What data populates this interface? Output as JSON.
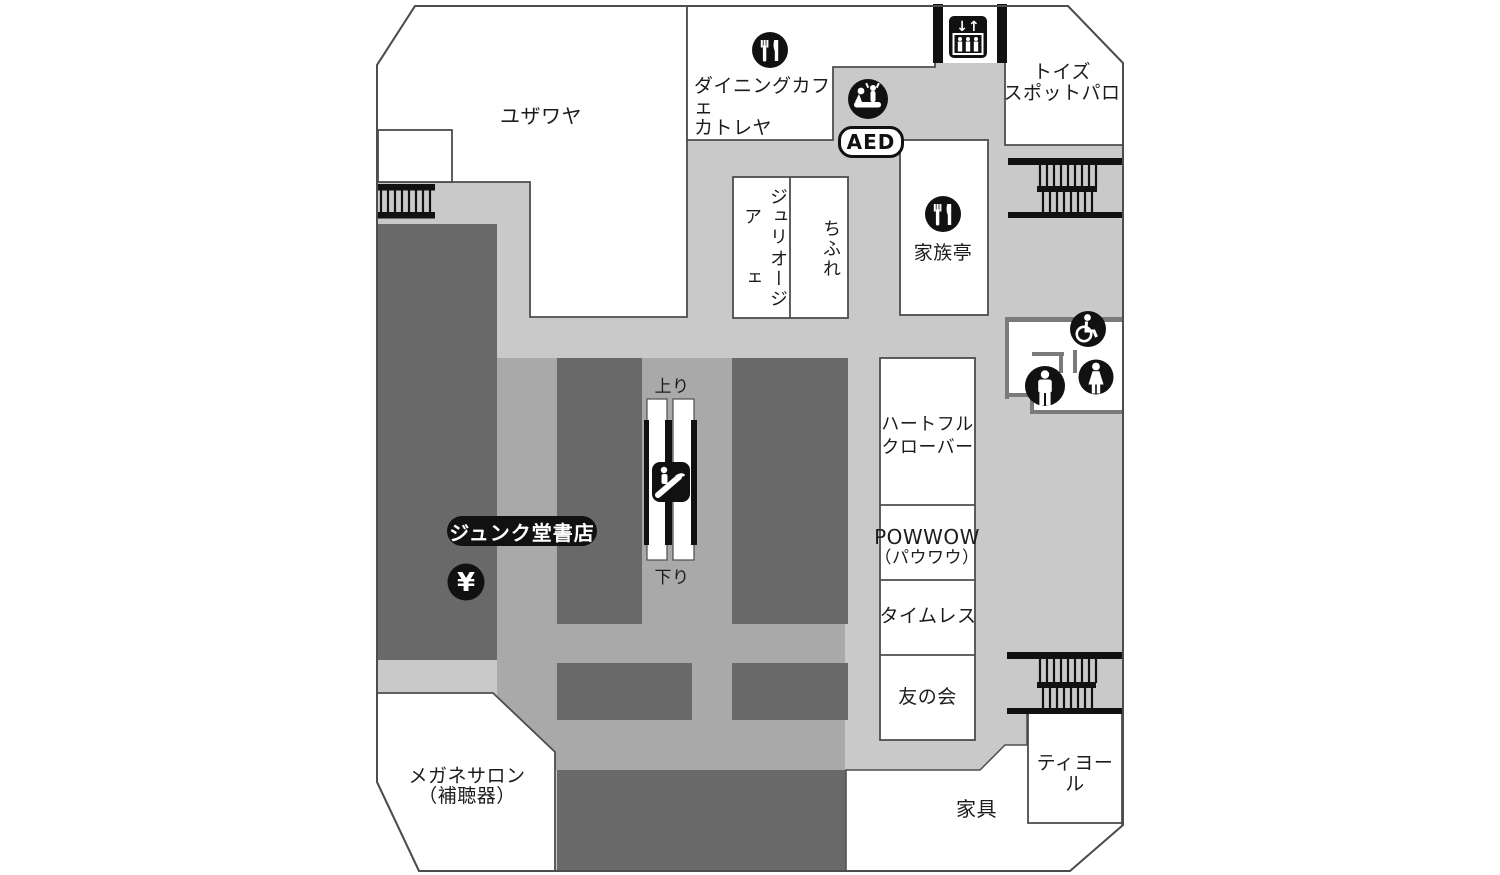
{
  "floor_map": {
    "stores": {
      "yuzawaya": {
        "name": "ユザワヤ"
      },
      "dining_cafe": {
        "line1": "ダイニングカフェ",
        "line2": "カトレヤ"
      },
      "toys_spot": {
        "line1": "トイズ",
        "line2": "スポットパロ"
      },
      "julia_oje": {
        "col1": "ジュリア",
        "col2": "オージェ"
      },
      "chifure": {
        "name": "ちふれ"
      },
      "kazokutei": {
        "name": "家族亭"
      },
      "heartful_clover": {
        "line1": "ハートフル",
        "line2": "クローバー"
      },
      "powwow": {
        "line1": "POWWOW",
        "line2": "（パウワウ）"
      },
      "timeless": {
        "name": "タイムレス"
      },
      "tomonokai": {
        "name": "友の会"
      },
      "junkudo": {
        "name": "ジュンク堂書店"
      },
      "megane_salon": {
        "line1": "メガネサロン",
        "line2": "（補聴器）"
      },
      "tiyol": {
        "name": "ティヨール"
      },
      "kagu": {
        "name": "家具"
      }
    },
    "labels": {
      "aed": "AED",
      "escalator_up": "上り",
      "escalator_down": "下り",
      "atm_symbol": "¥",
      "elevator_arrows": "↓↑"
    },
    "icons": {
      "restaurant": "fork-knife-circle",
      "elevator": "elevator-cabin-with-arrows",
      "aed": "cpr-first-aid-circle",
      "escalator": "escalator-square",
      "wheelchair": "wheelchair-circle",
      "mens_restroom": "man-circle",
      "womens_restroom": "woman-circle",
      "atm": "yen-circle",
      "stairs": "stairs-treads"
    },
    "colors": {
      "corridor": "#c9c9c9",
      "aisle": "#a9a9a9",
      "fixture_block": "#696969",
      "outline": "#4d4d4d",
      "wall_gray": "#7a7a7a",
      "icon_black": "#111111"
    }
  }
}
